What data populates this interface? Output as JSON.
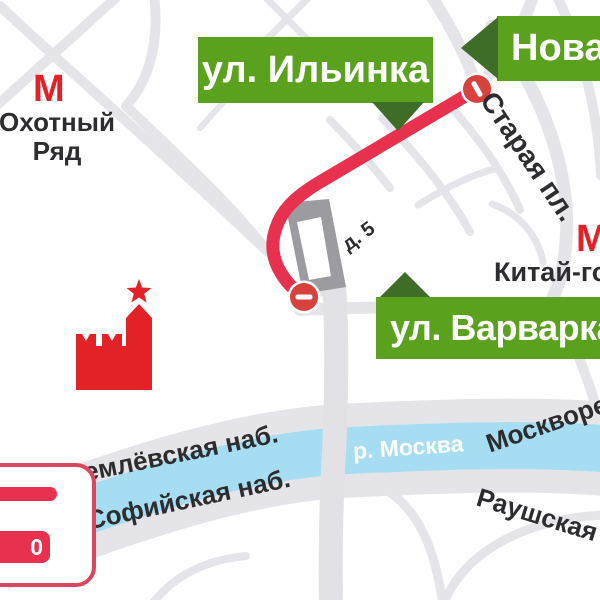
{
  "map": {
    "labels": {
      "ilyinka": "ул. Ильинка",
      "novaya": "Новая пл.",
      "varvarka": "ул. Варварка",
      "staraya": "Старая пл.",
      "building_no": "д. 5",
      "kremlevskaya_nab": "Кремлёвская наб.",
      "sofiyskaya_nab": "Софийская наб.",
      "moskvoretskaya_nab": "Москворецкая наб.",
      "raushskaya_nab": "Раушская наб.",
      "river": "р. Москва"
    },
    "metro": {
      "logo_glyph": "М",
      "okhotny_ryad": {
        "line1": "Охотный",
        "line2": "Ряд"
      },
      "kitay_gorod": "Китай-город"
    },
    "legend": {
      "badge_text": "0"
    },
    "colors": {
      "label_green": "#5aa11e",
      "pointer_green": "#3e6d28",
      "route_red": "#e8304f",
      "sign_red": "#d7423d",
      "metro_red": "#e22227",
      "river_blue": "#a7ddf2",
      "road_gray": "#e5e5e9",
      "bridge_gray": "#e1e1e6",
      "building_gray": "#9b9ba0",
      "legend_border": "#d9475f",
      "text_dark": "#2d2d2f"
    }
  }
}
